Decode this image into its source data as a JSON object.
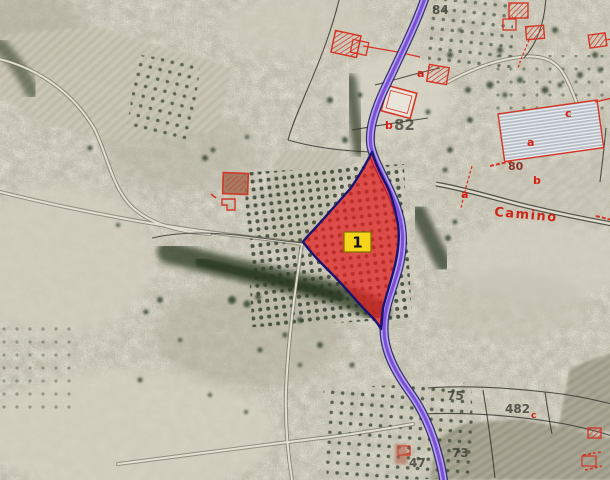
{
  "map": {
    "kind": "aerial-cadastral-orthophoto",
    "marker": {
      "label": "1"
    },
    "road_label": {
      "text": "84"
    },
    "path_label": {
      "text": "Camino"
    },
    "parcel_numbers": {
      "n82": "82",
      "n80": "80",
      "n75": "75",
      "n482": "482",
      "n73": "73",
      "n47": "47"
    },
    "subparcel_letters": {
      "a": "a",
      "b": "b",
      "c": "c"
    }
  },
  "colors": {
    "highlight_fill": "#e32020",
    "highlight_stroke": "#1a1470",
    "road_core": "#7e4fd8",
    "road_casing": "#b3a6ec",
    "road_edge": "#232065",
    "marker_bg": "#f6d41a",
    "marker_border": "#7a6f00",
    "cadastral_red": "#d42015",
    "camino_red": "#cc2418",
    "annotation_dark": "#3c3c33"
  }
}
